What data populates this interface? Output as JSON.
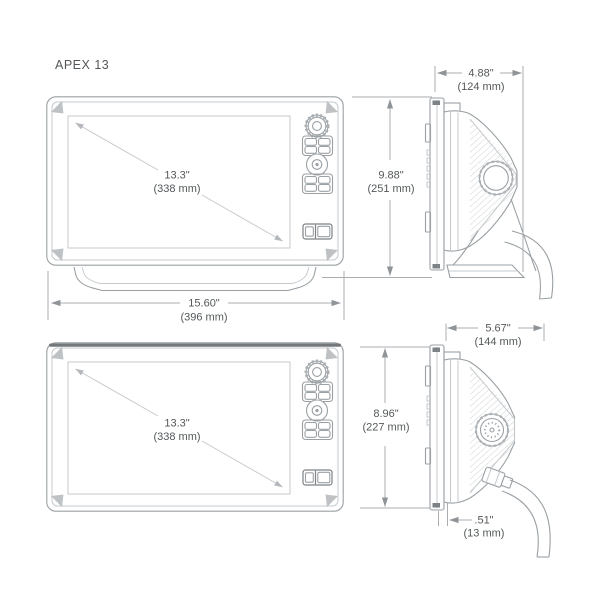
{
  "title": "APEX 13",
  "colors": {
    "text": "#54585a",
    "line": "#9aa0a4",
    "line_light": "#c6cacd",
    "line_dark": "#7d8286",
    "dim": "#a9aeb2",
    "background": "#ffffff"
  },
  "front_view": {
    "top": {
      "diagonal_in": "13.3\"",
      "diagonal_mm": "(338 mm)"
    },
    "bottom": {
      "diagonal_in": "13.3\"",
      "diagonal_mm": "(338 mm)"
    }
  },
  "dimensions": {
    "width": {
      "in": "15.60\"",
      "mm": "(396 mm)"
    },
    "depth_top": {
      "in": "4.88\"",
      "mm": "(124 mm)"
    },
    "height_top": {
      "in": "9.88\"",
      "mm": "(251 mm)"
    },
    "depth_bottom": {
      "in": "5.67\"",
      "mm": "(144 mm)"
    },
    "height_bottom": {
      "in": "8.96\"",
      "mm": "(227 mm)"
    },
    "lip_bottom": {
      "in": ".51\"",
      "mm": "(13 mm)"
    }
  }
}
